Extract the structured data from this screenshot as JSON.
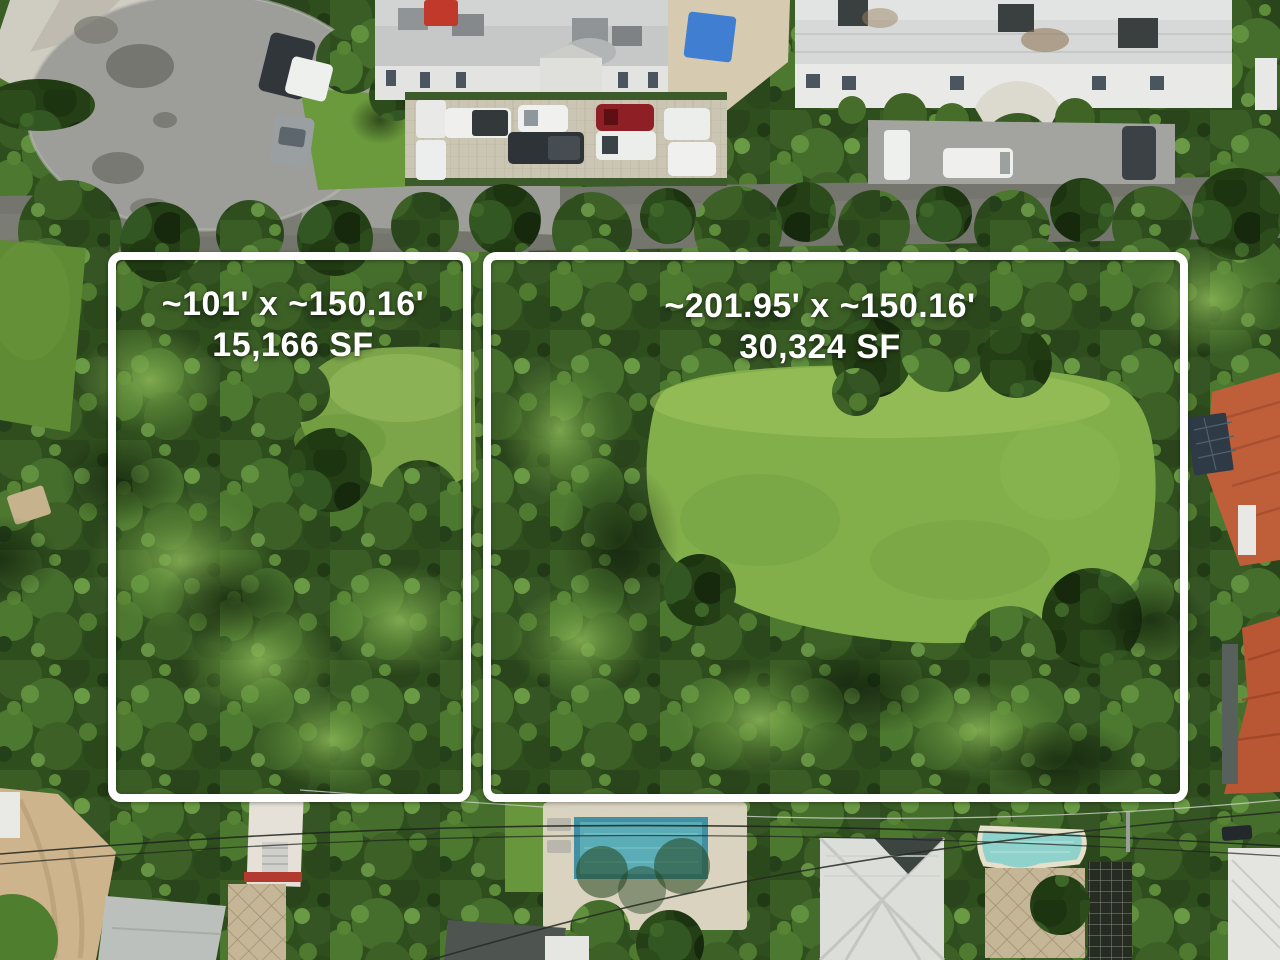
{
  "parcels": {
    "left": {
      "dimensions": "~101' x ~150.16'",
      "area": "15,166 SF"
    },
    "right": {
      "dimensions": "~201.95' x ~150.16'",
      "area": "30,324 SF"
    }
  },
  "colors": {
    "boundary": "#ffffff",
    "label_text": "#ffffff",
    "canopy": "#2f4e1e",
    "lawn_right_parcel": "#83af4b",
    "lawn_left_clearing": "#7ca448",
    "culdesac_asphalt": "#9d9d99",
    "road_asphalt": "#74756d",
    "paver_lot": "#cbc5b4",
    "roof_gray": "#c6c8c8",
    "roof_white": "#d7d9d8",
    "terracotta_roof": "#bf5f3a",
    "pool_center": "#5aacb6",
    "pool_right": "#8ed2cb",
    "dirt_path": "#cdb48d"
  }
}
